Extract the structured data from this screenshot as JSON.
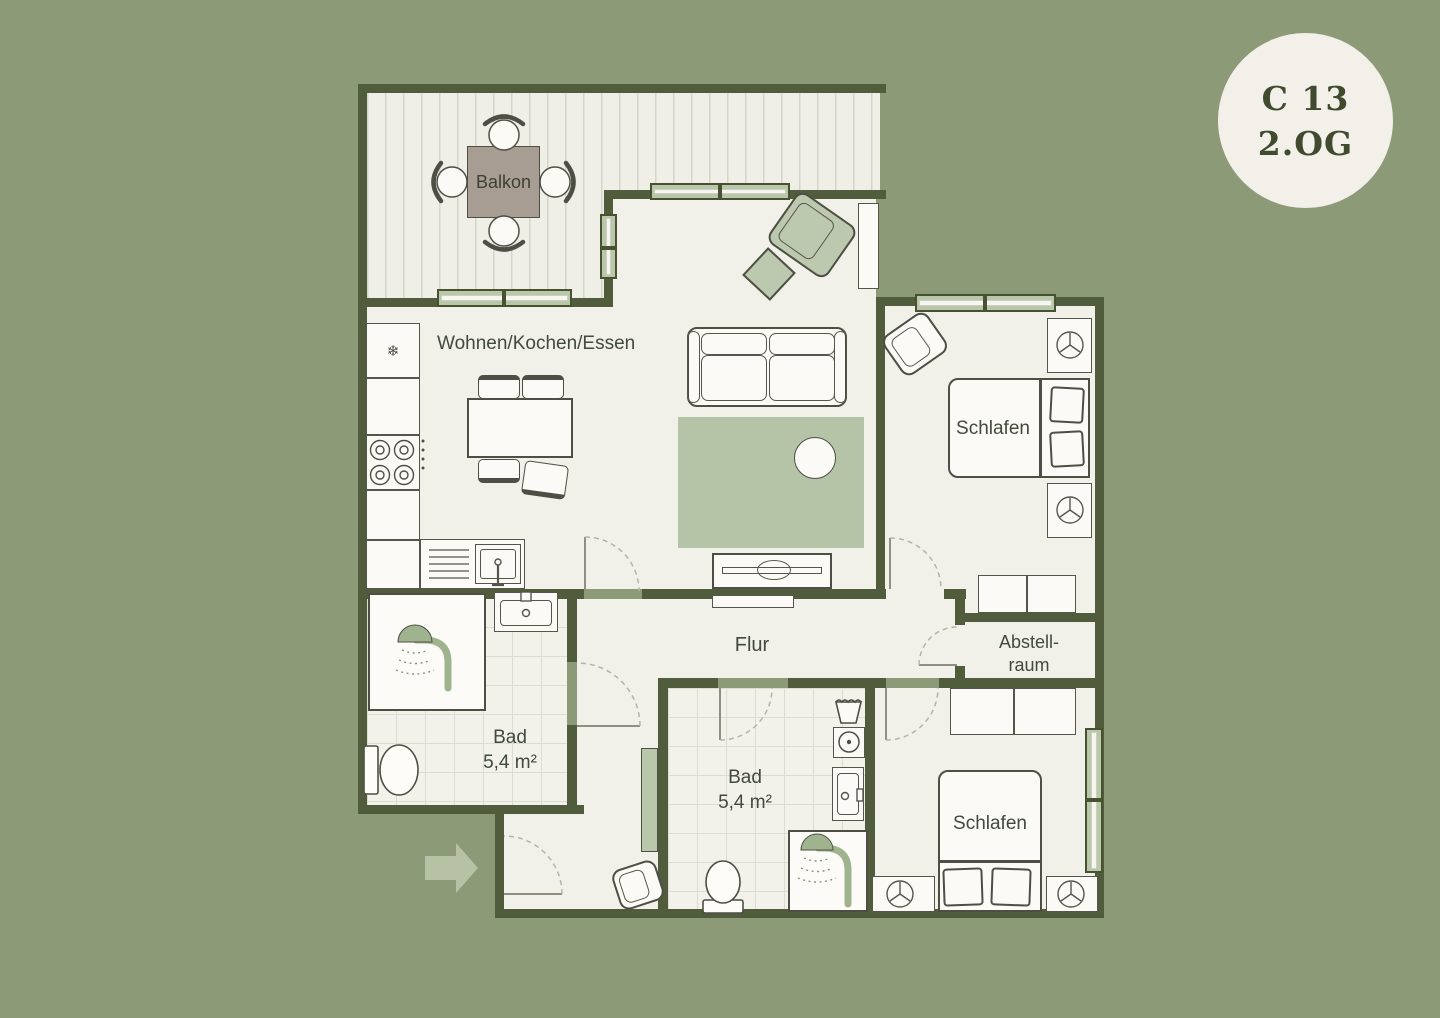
{
  "badge": {
    "unit": "C 13",
    "floor": "2.OG"
  },
  "rooms": {
    "balcony": {
      "label": "Balkon"
    },
    "living": {
      "label": "Wohnen/Kochen/Essen"
    },
    "hall": {
      "label": "Flur"
    },
    "storage": {
      "line1": "Abstell-",
      "line2": "raum"
    },
    "bedroom_top": {
      "label": "Schlafen"
    },
    "bedroom_bottom": {
      "label": "Schlafen"
    },
    "bath_left": {
      "label": "Bad",
      "area": "5,4 m²"
    },
    "bath_middle": {
      "label": "Bad",
      "area": "5,4 m²"
    }
  },
  "icons": {
    "fridge": "❄"
  },
  "colors": {
    "background": "#8C9A78",
    "wall": "#505C3B",
    "floor": "#F1F0E9",
    "accent_green": "#BCC9AE",
    "window_green": "#B9C7AB",
    "rug_green": "#B5C4A7",
    "outline": "#4D4F44",
    "balcony_table": "#A89D92",
    "badge_background": "#F2F0E9",
    "badge_text": "#3F4A2E",
    "label_text": "#414A3D",
    "entrance_arrow": "#B7C2A4"
  }
}
